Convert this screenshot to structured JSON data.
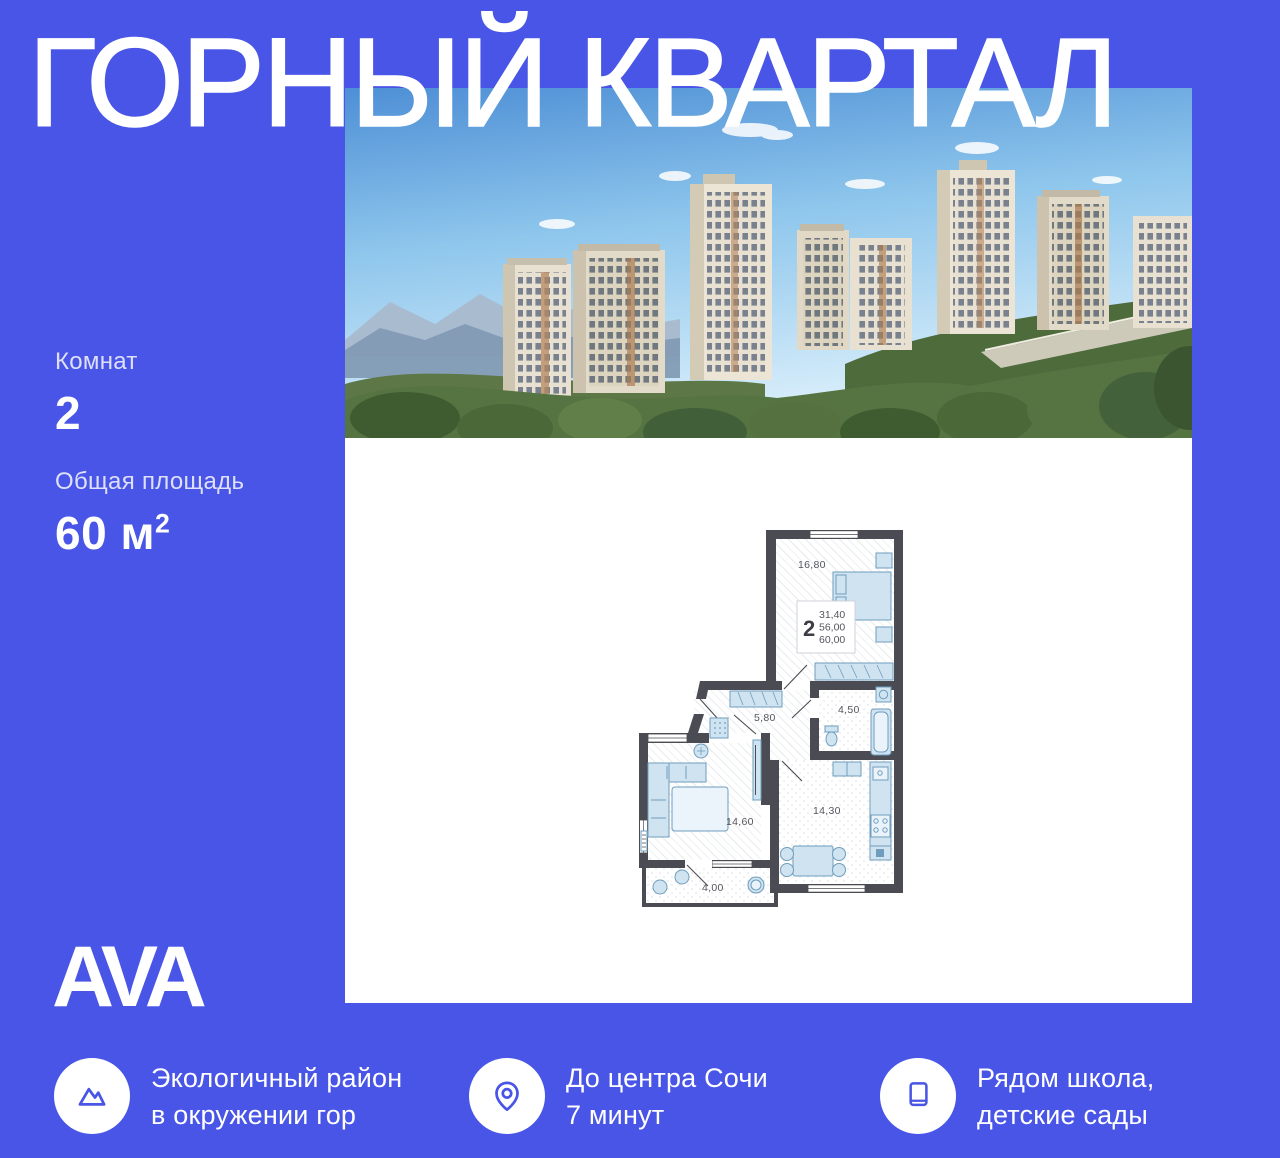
{
  "theme": {
    "background_color": "#4855e6",
    "panel_color": "#ffffff",
    "accent_color": "#4855e6",
    "title_color": "#ffffff",
    "plan_wall_color": "#4b4b53",
    "plan_furniture_color": "#cfe3f0",
    "plan_label_color": "#55555e"
  },
  "title": "ГОРНЫЙ КВАРТАЛ",
  "logo": "AVA",
  "photo": {
    "description": "residential-towers-in-forested-mountains-render"
  },
  "specs": [
    {
      "label": "Комнат",
      "value": "2"
    },
    {
      "label": "Общая площадь",
      "value": "60 м",
      "sup": "2"
    }
  ],
  "floorplan": {
    "info_card": {
      "rooms": "2",
      "living_area": "31,40",
      "area_without_balcony": "56,00",
      "total_area": "60,00"
    },
    "rooms": [
      {
        "name": "bedroom",
        "area": "16,80"
      },
      {
        "name": "hallway",
        "area": "5,80"
      },
      {
        "name": "bathroom",
        "area": "4,50"
      },
      {
        "name": "living-room",
        "area": "14,60"
      },
      {
        "name": "kitchen",
        "area": "14,30"
      },
      {
        "name": "balcony",
        "area": "4,00"
      }
    ]
  },
  "features": [
    {
      "icon": "mountains-icon",
      "lines": [
        "Экологичный район",
        "в окружении гор"
      ]
    },
    {
      "icon": "location-pin-icon",
      "lines": [
        "До центра Сочи",
        "7 минут"
      ]
    },
    {
      "icon": "book-icon",
      "lines": [
        "Рядом школа,",
        "детские сады"
      ]
    }
  ]
}
